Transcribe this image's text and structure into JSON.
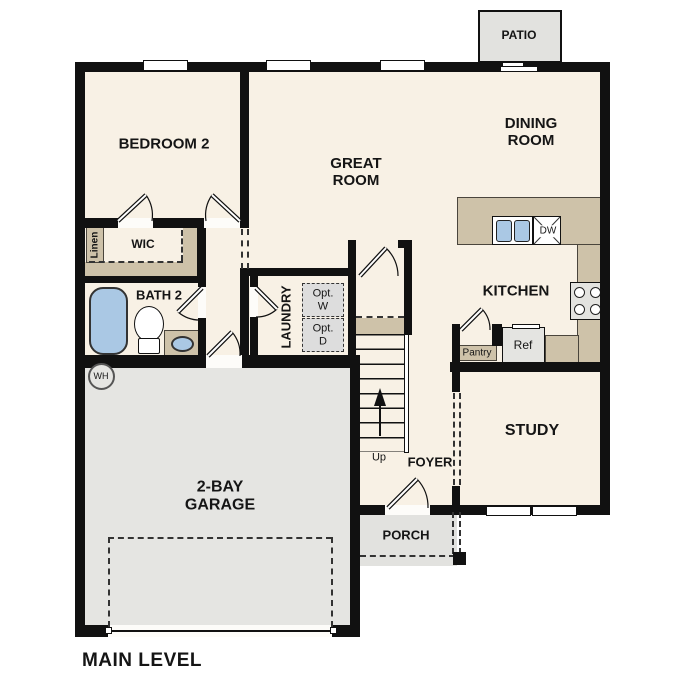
{
  "level_label": "MAIN LEVEL",
  "rooms": {
    "patio": "PATIO",
    "bedroom2": "BEDROOM 2",
    "great_room": "GREAT\nROOM",
    "dining_room": "DINING\nROOM",
    "kitchen": "KITCHEN",
    "wic": "WIC",
    "linen": "Linen",
    "bath2": "BATH 2",
    "laundry": "LAUNDRY",
    "study": "STUDY",
    "foyer": "FOYER",
    "garage": "2-BAY\nGARAGE",
    "porch": "PORCH"
  },
  "fixtures": {
    "optional_washer": "Opt.\nW",
    "optional_dryer": "Opt.\nD",
    "dishwasher": "DW",
    "refrigerator": "Ref",
    "pantry": "Pantry",
    "water_heater": "WH",
    "stairs_direction": "Up"
  },
  "colors": {
    "wall": "#111111",
    "floor": "#f8f1e5",
    "counter_tan": "#cec2a9",
    "fixture_blue": "#aac8e4",
    "garage_gray": "#e5e5e2",
    "exterior_gray": "#e2e2df",
    "optional_appliance_gray": "#dddddd"
  }
}
